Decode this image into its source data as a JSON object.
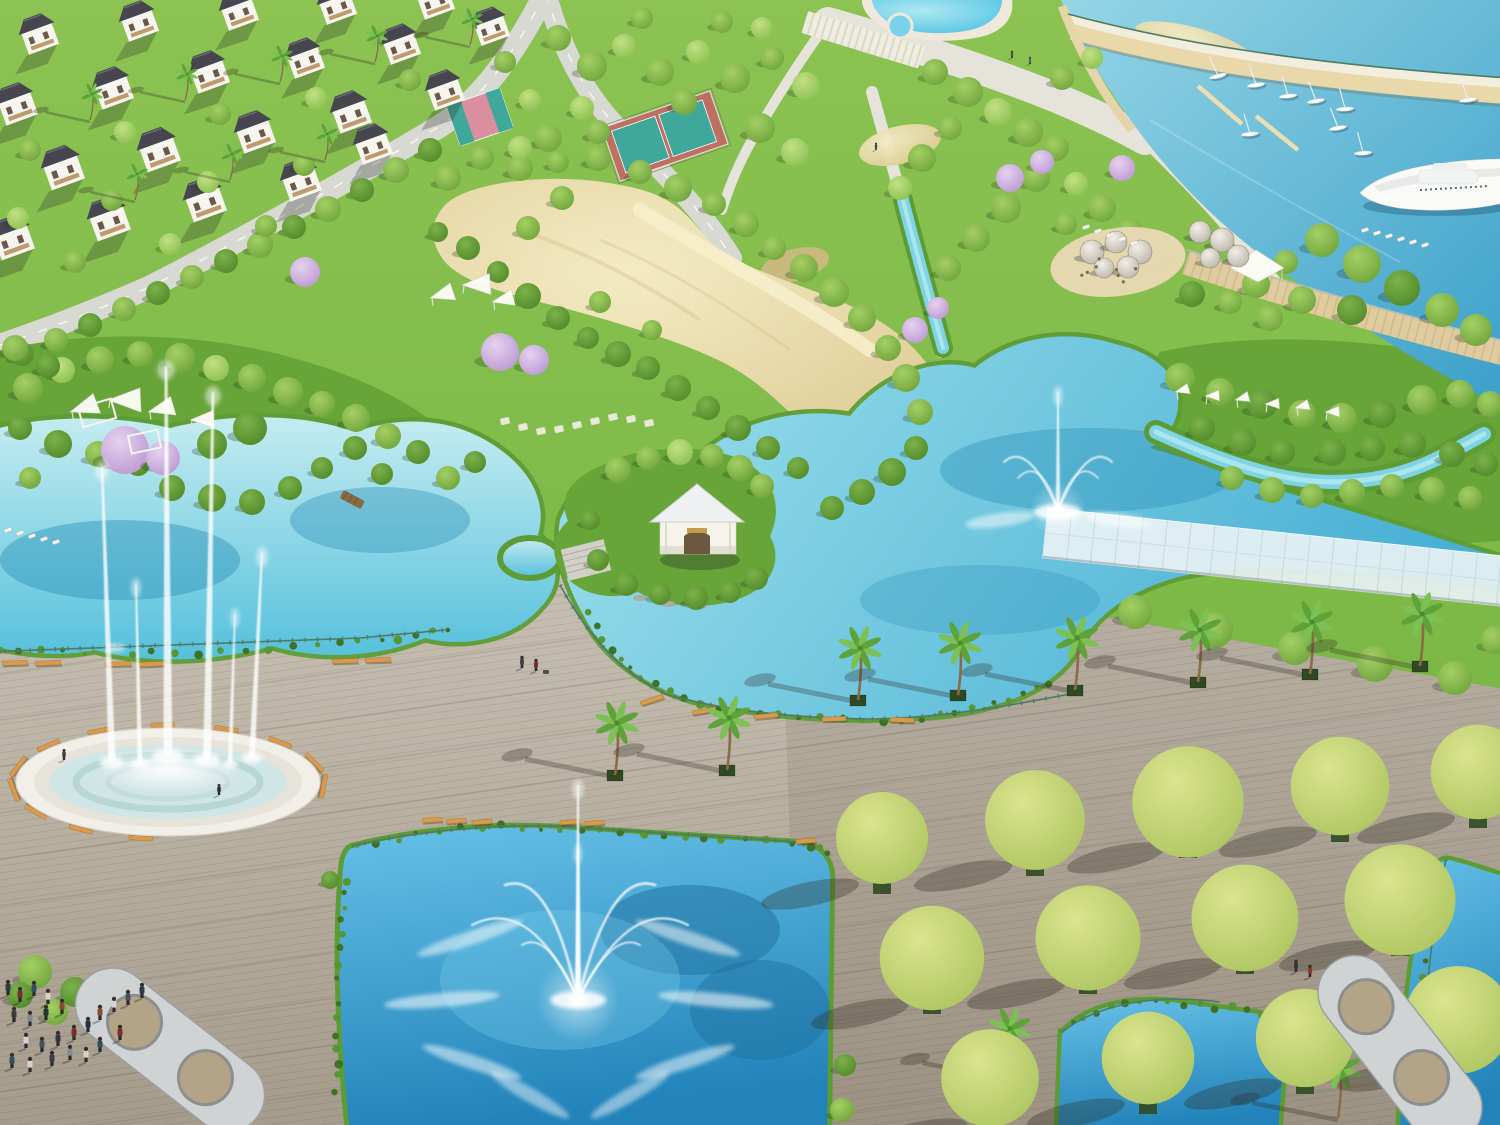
{
  "scene": {
    "name": "waterfront-park-aerial-render",
    "type": "aerial 3D architectural rendering",
    "visible_text": [],
    "regions": [
      {
        "id": "villa-district",
        "desc": "rows of white villas with dark hip roofs and palms, top left"
      },
      {
        "id": "sports-courts",
        "desc": "pink basketball court and two teal tennis courts"
      },
      {
        "id": "swimming-pools",
        "desc": "free-form blue pools with white aprons, top centre"
      },
      {
        "id": "marina",
        "desc": "harbor basin with sailboats, quays, pier and a large white yacht, top right"
      },
      {
        "id": "cafe-terrace",
        "desc": "sandy terrace with dome parasols, loungers and white tent"
      },
      {
        "id": "sand-garden",
        "desc": "large kidney-shaped sand beach inside the park"
      },
      {
        "id": "left-lake",
        "desc": "turquoise lagoon with green island, pergolas and purple blossom"
      },
      {
        "id": "central-lake",
        "desc": "lake with crown spray fountain, streams and glass canopy"
      },
      {
        "id": "lakeside-kiosk",
        "desc": "small white pavilion on an island with stone steps"
      },
      {
        "id": "palm-promenade",
        "desc": "palm-lined timber boardwalk between the lakes"
      },
      {
        "id": "plaza-fountain",
        "desc": "circular basin with very tall water jets ringed by benches"
      },
      {
        "id": "south-pond",
        "desc": "square pond with fan fountain and radial sprays"
      },
      {
        "id": "tree-grid",
        "desc": "grid of round trees in planters on the lower-right deck"
      },
      {
        "id": "wave-pavilions",
        "desc": "curved looping shelter structures on the deck"
      },
      {
        "id": "visitors",
        "desc": "groups of people on the boardwalk"
      }
    ],
    "counts": {
      "sailboats": 9,
      "yachts": 1,
      "dome_parasols": 9,
      "promenade_palms": 8,
      "plaza_fountain_jets": 6,
      "grid_trees": 13,
      "villas": 21
    }
  },
  "palette": {
    "grass1": "#8cc353",
    "grass2": "#72b13e",
    "mass": "#67a539",
    "tree_light1": "#c3e083",
    "tree_light2": "#84bd4c",
    "tree_mid1": "#a4d065",
    "tree_mid2": "#699f37",
    "tree_dark1": "#7cb24a",
    "tree_dark2": "#4c8527",
    "tree_yellow1": "#dbe48e",
    "tree_yellow2": "#a9c25c",
    "blossom1": "#e6d2f0",
    "blossom2": "#b792cf",
    "lake_left1": "#c4ecf0",
    "lake_left2": "#55c0dc",
    "lake_c1": "#9fe2ec",
    "lake_c2": "#49b0d4",
    "marina1": "#96d6e6",
    "marina2": "#3a9fc9",
    "pond1": "#66c0e6",
    "pond2": "#2183ba",
    "sand1": "#f4ebc4",
    "sand2": "#dbc890",
    "deck1": "#c8c1b3",
    "deck2": "#a59b8b",
    "dome1": "#f2efe8",
    "dome2": "#b5afa2",
    "pool1": "#aee8f2",
    "pool2": "#4cc2e2",
    "road": "#d9d9d4",
    "road_line": "#ffffff",
    "path": "#e6e3da",
    "quay": "#e9d8aa",
    "quay_walk": "#f2eedd",
    "pier": "#e0cb9e",
    "fringe": "#5d9c35",
    "fringe_dark": "#3f7226",
    "stream": "#7fd4e4",
    "stream_core": "#c8f0f4",
    "glass": "#e9f3f5",
    "glass_line": "#bfd4da",
    "bench": "#d89a4c",
    "bench_edge": "#a5702f",
    "railing": "#4d7a64",
    "roof": "#474650",
    "wall": "#f7f5f0",
    "window": "#6b5948",
    "balcony": "#b58a55",
    "trunk": "#8a6b46",
    "palm_a": "#5ea33a",
    "palm_b": "#7cc153",
    "planter": "#2f4a22",
    "lake_deep": "#2d92b8",
    "pond_deep": "#1d6f9e",
    "shallow": "#b9ecf2",
    "rim": "#f1efe8",
    "basin1": "#e6e4da",
    "basin2": "#cfe5e6",
    "ring": "#b2d0d2",
    "court_teal": "#3fa89a",
    "court_apron": "#bf6f62",
    "court_pink": "#d98f9e",
    "patio": "#ead9b4",
    "tent": "#fcfcf7",
    "stone": "#f1efe6",
    "steps": "#d2d0c8",
    "wood_bridge": "#8a6a42",
    "pergola_shell": "#cfd3d4",
    "pergola_edge": "#9aa0a2",
    "pergola_floor": "#b3a487",
    "people": [
      "#2e3a4a",
      "#7a2d2d",
      "#31505e",
      "#d8d4cc",
      "#3c3c44",
      "#7e8890",
      "#26323e",
      "#8a4a3a",
      "#cfd5da",
      "#44525e"
    ]
  }
}
